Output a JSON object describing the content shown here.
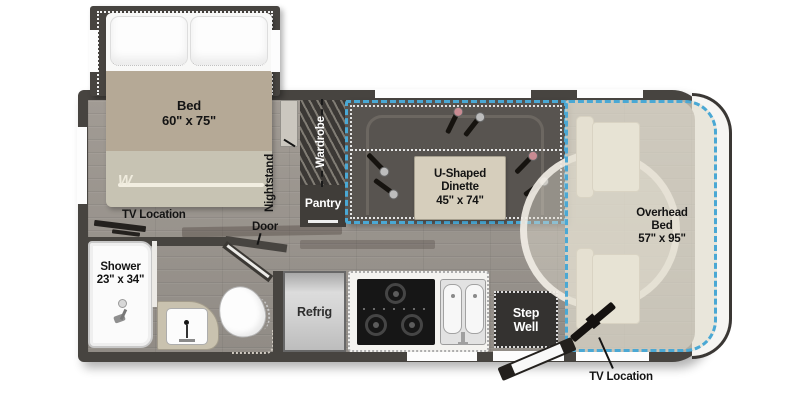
{
  "labels": {
    "bed": {
      "name": "Bed",
      "dims": "60\" x 75\""
    },
    "nightstand": "Nightstand",
    "wardrobe": "Wardrobe",
    "pantry": "Pantry",
    "dinette": {
      "l1": "U-Shaped",
      "l2": "Dinette",
      "dims": "45\" x 74\""
    },
    "overhead": {
      "l1": "Overhead",
      "l2": "Bed",
      "dims": "57\" x 95\""
    },
    "tv_bedroom": "TV Location",
    "door": "Door",
    "shower": {
      "name": "Shower",
      "dims": "23\" x 34\""
    },
    "refrig": "Refrig",
    "stepwell": {
      "l1": "Step",
      "l2": "Well"
    },
    "tv_cab": "TV Location",
    "brand_initial": "W"
  },
  "colors": {
    "wall": "#474440",
    "accent": "#4aa8d4",
    "bench": "#585450",
    "tbl": "#d6cebc",
    "blanket": "#b5a996",
    "seat": "#f0ebdc",
    "step": "#343230"
  }
}
